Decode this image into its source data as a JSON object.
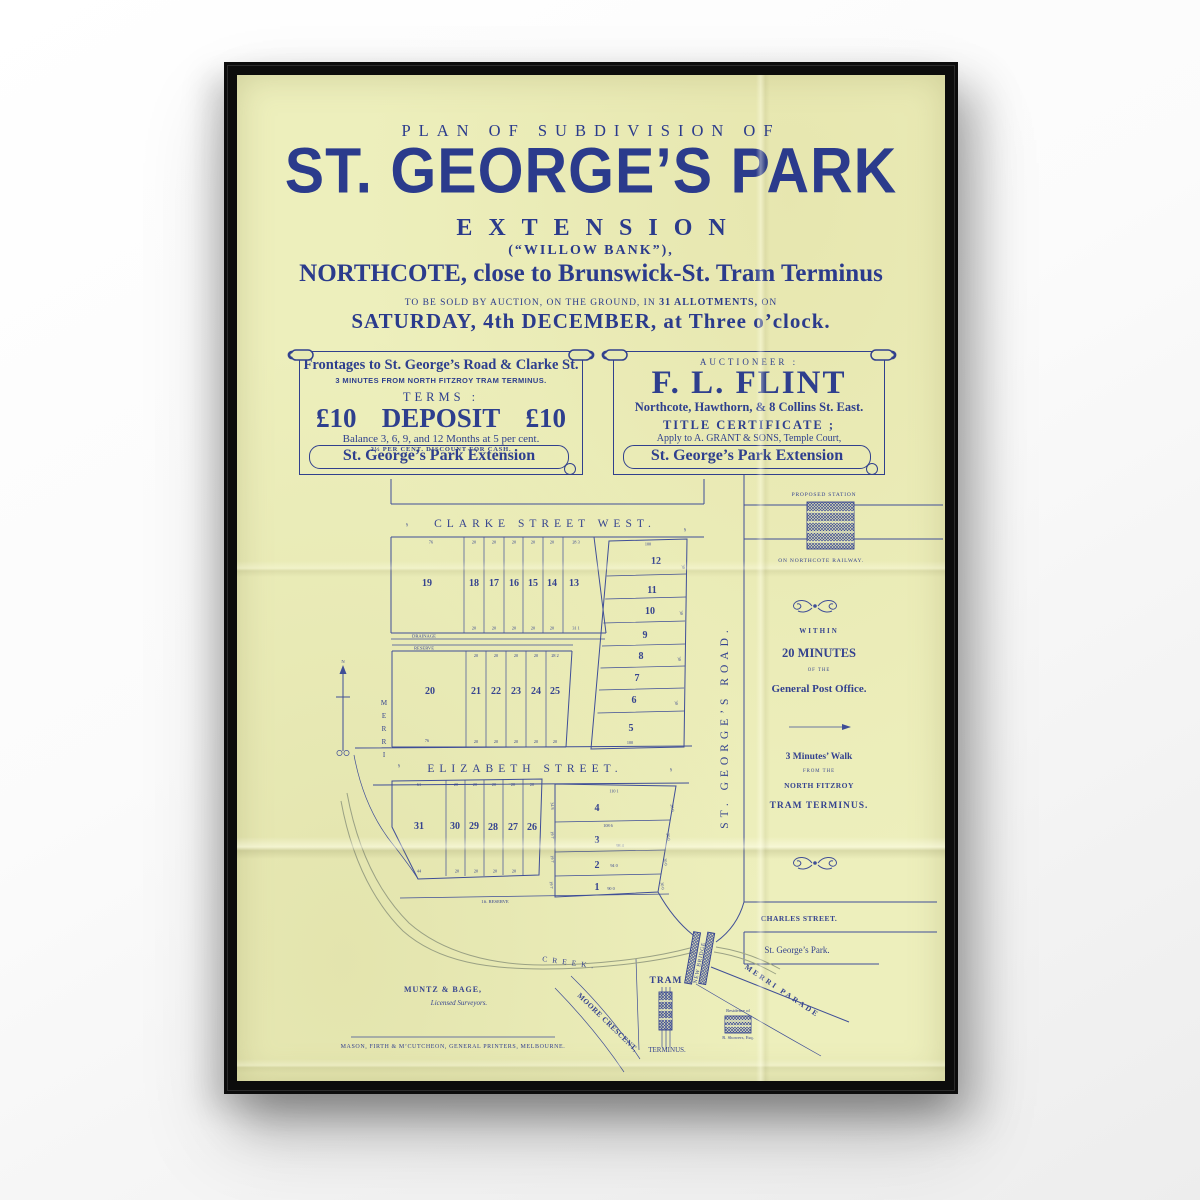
{
  "poster": {
    "header": {
      "plan_line": "PLAN OF SUBDIVISION OF",
      "title": "ST. GEORGE’S PARK",
      "subtitle": "EXTENSION",
      "alt_name": "(“WILLOW BANK”),",
      "location_line": "NORTHCOTE, close to Brunswick-St. Tram Terminus",
      "auction_pre": "TO BE SOLD BY AUCTION, ON THE GROUND, IN",
      "auction_bold": "31 ALLOTMENTS,",
      "auction_post": "ON",
      "date_line": "SATURDAY, 4th DECEMBER, at Three o’clock."
    },
    "left_scroll": {
      "line1": "Frontages to St. George’s Road & Clarke St.",
      "line2": "3 MINUTES FROM NORTH FITZROY TRAM TERMINUS.",
      "terms_label": "TERMS :",
      "deposit_left": "£10",
      "deposit_word": "DEPOSIT",
      "deposit_right": "£10",
      "balance_line": "Balance 3, 6, 9, and 12 Months at 5 per cent.",
      "discount_line": "2½ PER CENT. DISCOUNT FOR CASH.",
      "ribbon": "St. George’s Park Extension"
    },
    "right_scroll": {
      "auctioneer_label": "AUCTIONEER :",
      "name": "F. L. FLINT",
      "address": "Northcote, Hawthorn, & 8 Collins St. East.",
      "title_cert": "TITLE CERTIFICATE ;",
      "apply_line": "Apply to A. GRANT & SONS, Temple Court,",
      "ribbon": "St. George’s Park Extension"
    },
    "map": {
      "streets": {
        "clarke": "CLARKE STREET WEST.",
        "elizabeth": "ELIZABETH STREET.",
        "st_georges": "ST. GEORGE’S ROAD.",
        "charles": "CHARLES STREET.",
        "merri_parade": "MERRI PARADE",
        "moore": "MOORE CRESCENT,",
        "merri": "MERRI",
        "creek": "CREEK.",
        "park": "St. George’s Park."
      },
      "labels": {
        "proposed_station": "PROPOSED STATION",
        "on_railway": "ON NORTHCOTE RAILWAY.",
        "drainage": "DRAINAGE",
        "reserve": "RESERVE",
        "ft_reserve": "1ft. RESERVE",
        "new_bridge": "NEW BRIDGE",
        "tram": "TRAM",
        "terminus": "TERMINUS.",
        "residence_of": "Residence of",
        "residence_name": "R. Showers, Esq.",
        "north": "N",
        "section_mark": "§"
      },
      "lots": {
        "row_a": [
          "19",
          "18",
          "17",
          "16",
          "15",
          "14",
          "13"
        ],
        "lot20": "20",
        "row_b": [
          "21",
          "22",
          "23",
          "24",
          "25"
        ],
        "col_c": [
          "12",
          "11",
          "10",
          "9",
          "8",
          "7",
          "6",
          "5"
        ],
        "row_d": [
          "31",
          "30",
          "29",
          "28",
          "27",
          "26"
        ],
        "col_e": [
          "4",
          "3",
          "2",
          "1"
        ]
      },
      "dims": {
        "a_top": [
          "76",
          "20",
          "20",
          "20",
          "20",
          "20",
          "28 3"
        ],
        "a_bottom": [
          "20",
          "20",
          "20",
          "20",
          "20",
          "31 1"
        ],
        "b_top": [
          "20",
          "20",
          "20",
          "20",
          "28 2"
        ],
        "b_bottom": [
          "20",
          "20",
          "20",
          "20",
          "20"
        ],
        "b20": "76",
        "c_top": "100",
        "c_bottom": "100",
        "c_side": [
          "30",
          "30",
          "30",
          "30"
        ],
        "d_top": [
          "61",
          "20",
          "20",
          "20",
          "20",
          "20"
        ],
        "d_bottom": [
          "44",
          "20",
          "20",
          "20",
          "20"
        ],
        "e_top": "110 1",
        "e_rows": [
          "108 6",
          "98 4",
          "94 0",
          "90 0"
        ],
        "e_side": [
          "28 0",
          "20 0",
          "20 0",
          "30 0"
        ],
        "strip": [
          "34 8",
          "19 7",
          "19 7",
          "19 7"
        ]
      },
      "right_panel": {
        "within": "WITHIN",
        "minutes": "20 MINUTES",
        "of_the": "OF THE",
        "gpo": "General Post Office.",
        "walk": "3 Minutes’ Walk",
        "from_the": "FROM THE",
        "fitzroy": "NORTH FITZROY",
        "tram_terminus": "TRAM TERMINUS."
      },
      "footer": {
        "surveyors": "MUNTZ & BAGE,",
        "surveyors2": "Licensed Surveyors.",
        "printer": "MASON, FIRTH & M’CUTCHEON, GENERAL PRINTERS, MELBOURNE."
      }
    },
    "colors": {
      "ink": "#2e3f8e",
      "map_ink": "#3f4e97",
      "paper": "#edefbc",
      "frame": "#0c0c0c",
      "creek": "#9aa184"
    }
  }
}
